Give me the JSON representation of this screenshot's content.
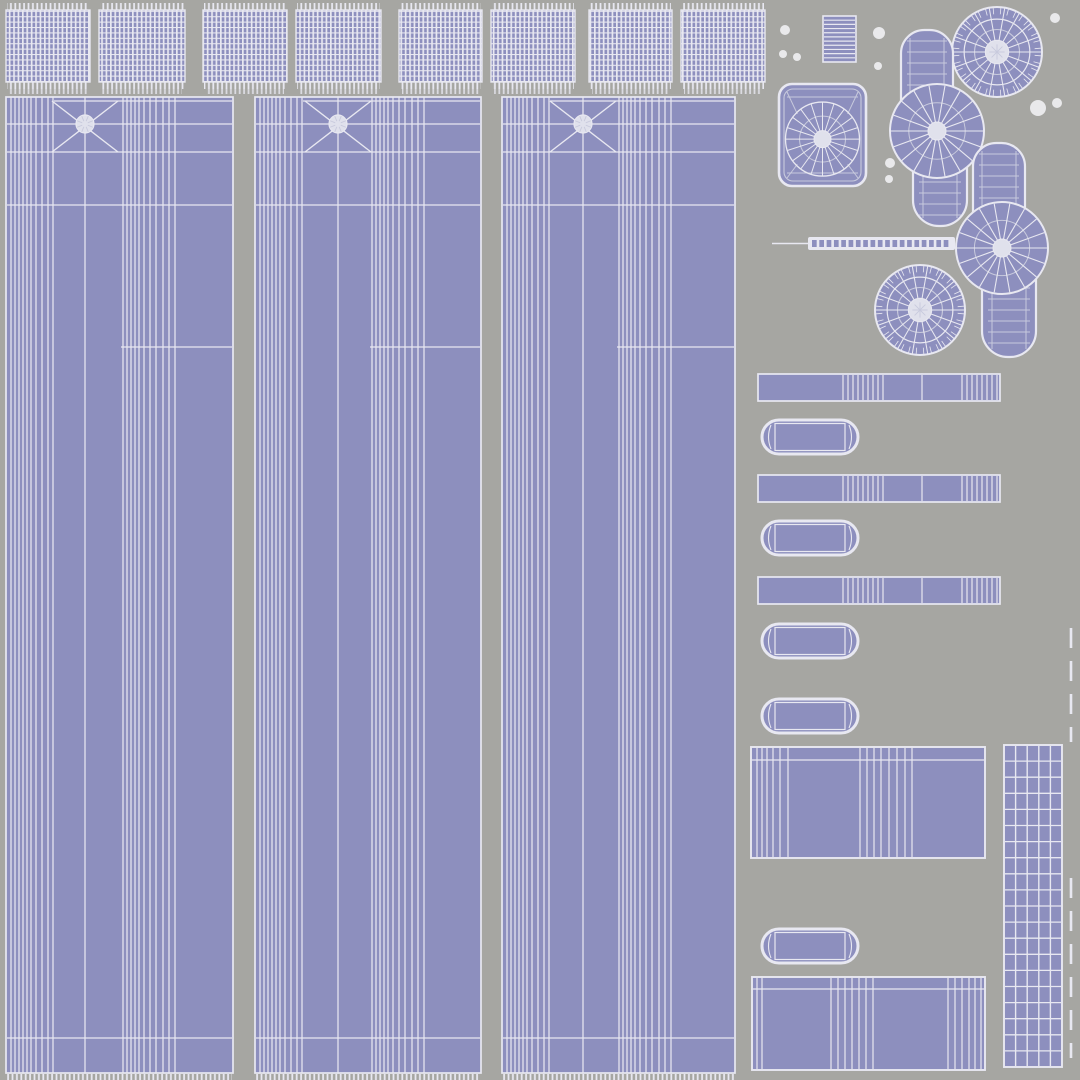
{
  "canvas": {
    "w": 1080,
    "h": 1080,
    "bg": "#a6a6a2"
  },
  "palette": {
    "fill": "#8d8fbe",
    "line": "#e8e8f1",
    "soft": "#c8cadd",
    "hub": "#e0e1ec",
    "dot": "#e9e9eb"
  },
  "top_patches": {
    "y": 10,
    "h": 72,
    "items": [
      {
        "x": 6,
        "w": 84
      },
      {
        "x": 99,
        "w": 86
      },
      {
        "x": 203,
        "w": 84
      },
      {
        "x": 296,
        "w": 85
      },
      {
        "x": 399,
        "w": 83
      },
      {
        "x": 491,
        "w": 84
      },
      {
        "x": 589,
        "w": 83
      },
      {
        "x": 681,
        "w": 84
      }
    ]
  },
  "columns": {
    "top": 97,
    "bottom": 1073,
    "items": [
      {
        "x": 6,
        "w": 227,
        "star_cx": 79
      },
      {
        "x": 255,
        "w": 226,
        "star_cx": 83
      },
      {
        "x": 502,
        "w": 233,
        "star_cx": 81
      }
    ],
    "star": {
      "cy": 124,
      "arm": 33,
      "arm_top": 101,
      "arm_bot": 152,
      "hub_r": 9
    },
    "v_offsets": [
      5,
      9,
      13,
      17,
      21,
      25,
      30,
      36,
      42,
      47,
      117,
      121,
      125,
      129,
      133,
      138,
      144,
      150,
      157,
      163,
      169
    ],
    "h_lines": [
      {
        "y": 101,
        "from": 48,
        "to": -1
      },
      {
        "y": 124,
        "from": 1,
        "to": -1
      },
      {
        "y": 152,
        "from": 1,
        "to": -1
      },
      {
        "y": 205,
        "from": 1,
        "to": -1
      },
      {
        "y": 347,
        "from": 115,
        "to": -1
      },
      {
        "y": 1038,
        "from": 1,
        "to": -1
      }
    ]
  },
  "bar_detail": {
    "cluster1_start": 85,
    "cluster1_count": 9,
    "cluster1_step": 5,
    "single": 164,
    "cluster2_start": 204,
    "cluster2_count": 8,
    "cluster2_step": 5
  },
  "right_islands": [
    {
      "type": "striped_rect",
      "name": "striped-patch",
      "x": 823,
      "y": 16,
      "w": 33,
      "h": 46,
      "stripes": 10
    },
    {
      "type": "cap_square",
      "name": "cap-square",
      "x": 779,
      "y": 84,
      "w": 87,
      "h": 102
    },
    {
      "type": "disc",
      "name": "disc-top-right",
      "cx": 997,
      "cy": 52,
      "r": 45
    },
    {
      "type": "disc",
      "name": "disc-middle",
      "cx": 920,
      "cy": 310,
      "r": 45
    },
    {
      "type": "peanut",
      "name": "peanut-upper",
      "fan_cx": 937,
      "fan_cy": 131,
      "r": 47,
      "top_cx": 927,
      "top_y": 30,
      "bot_cx": 940,
      "bot_y": 226,
      "lobe_w": 52
    },
    {
      "type": "peanut",
      "name": "peanut-lower",
      "fan_cx": 1002,
      "fan_cy": 248,
      "r": 46,
      "top_cx": 999,
      "top_y": 143,
      "bot_cx": 1009,
      "bot_y": 357,
      "lobe_w": 52
    },
    {
      "type": "dash_strip",
      "name": "dashed-strip",
      "x": 808,
      "y": 237,
      "w": 147,
      "h": 13,
      "dashes": 19,
      "lead": 36
    },
    {
      "type": "bar",
      "name": "tread-bar-1",
      "x": 758,
      "y": 374,
      "w": 242,
      "h": 27
    },
    {
      "type": "bar",
      "name": "tread-bar-2",
      "x": 758,
      "y": 475,
      "w": 242,
      "h": 27
    },
    {
      "type": "bar",
      "name": "tread-bar-3",
      "x": 758,
      "y": 577,
      "w": 242,
      "h": 27
    },
    {
      "type": "pill",
      "name": "pill-1",
      "x": 762,
      "y": 420,
      "w": 96,
      "h": 34
    },
    {
      "type": "pill",
      "name": "pill-2",
      "x": 762,
      "y": 521,
      "w": 96,
      "h": 34
    },
    {
      "type": "pill",
      "name": "pill-3",
      "x": 762,
      "y": 624,
      "w": 96,
      "h": 34
    },
    {
      "type": "pill",
      "name": "pill-4",
      "x": 762,
      "y": 699,
      "w": 96,
      "h": 34
    },
    {
      "type": "pill",
      "name": "pill-5",
      "x": 762,
      "y": 929,
      "w": 96,
      "h": 34
    },
    {
      "type": "big_rect",
      "name": "panel-rect-1",
      "x": 751,
      "y": 747,
      "w": 234,
      "h": 111,
      "hline": 13,
      "clusters": [
        [
          6,
          11,
          16,
          22,
          29,
          37
        ],
        [
          109,
          116,
          123,
          130,
          138,
          146,
          154
        ],
        [
          161
        ]
      ]
    },
    {
      "type": "big_rect",
      "name": "panel-rect-2",
      "x": 752,
      "y": 977,
      "w": 233,
      "h": 93,
      "hline": 12,
      "clusters": [
        [
          5,
          10
        ],
        [
          79,
          86,
          93,
          100,
          107,
          114,
          121
        ],
        [
          196,
          203,
          210,
          217,
          223,
          229
        ]
      ]
    },
    {
      "type": "grid_rect",
      "name": "tall-grid",
      "x": 1004,
      "y": 745,
      "w": 58,
      "h": 322,
      "cols": 5,
      "rows": 20
    },
    {
      "type": "dash_vline",
      "name": "dashed-vertical-line-upper",
      "x": 1071,
      "y1": 628,
      "y2": 742
    },
    {
      "type": "dash_vline",
      "name": "dashed-vertical-line-lower",
      "x": 1071,
      "y1": 878,
      "y2": 1058
    }
  ],
  "dots": [
    {
      "cx": 785,
      "cy": 30,
      "r": 5
    },
    {
      "cx": 783,
      "cy": 54,
      "r": 4
    },
    {
      "cx": 797,
      "cy": 57,
      "r": 4
    },
    {
      "cx": 879,
      "cy": 33,
      "r": 6
    },
    {
      "cx": 878,
      "cy": 66,
      "r": 4
    },
    {
      "cx": 1055,
      "cy": 18,
      "r": 5
    },
    {
      "cx": 1038,
      "cy": 108,
      "r": 8
    },
    {
      "cx": 1057,
      "cy": 103,
      "r": 5
    },
    {
      "cx": 890,
      "cy": 163,
      "r": 5
    },
    {
      "cx": 889,
      "cy": 179,
      "r": 4
    }
  ]
}
